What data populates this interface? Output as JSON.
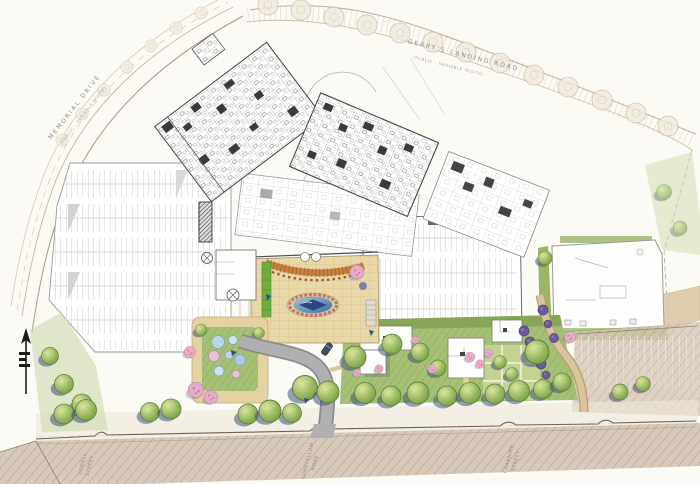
{
  "drawing": {
    "kind": "hand-rendered illustrative site plan",
    "labels": {
      "memorial": {
        "name": "MEMORIAL   DRIVE",
        "sub": "(PUBLIC - VARIABLE WIDTH)"
      },
      "gerrys": {
        "name": "GERRY'S   LANDING   ROAD",
        "sub": "(PUBLIC - VARIABLE WIDTH)"
      },
      "lowell": {
        "l1": "LOWELL",
        "l2": "STREET"
      },
      "longfellow": {
        "l1": "LONGFELLOW",
        "l2": "ROAD"
      },
      "channing": {
        "l1": "CHANNING",
        "l2": "STREET"
      }
    },
    "features": {
      "north_arrow": "north-arrow-and-scale",
      "hospital": "main-hospital-building-plan",
      "west_parking": "west-parking-lot",
      "east_parking": "east-parking-deck",
      "plaza": "entry-plaza-courtyard",
      "pond": "oval-reflecting-pool",
      "trellis": "curved-entry-trellis",
      "childrens_garden": "childrens-garden",
      "cottages": "garden-cottages",
      "street_trees": "street-tree-row",
      "south_road": "mount-auburn-street-roadbed"
    },
    "palette": {
      "paper": "#fbfaf5",
      "plaza_tan": "#e9d9a8",
      "pond_deep": "#1e3f73",
      "trellis_orange": "#c87f3e",
      "lawn_green": "#a6c076",
      "tree_green": "#8cb05b",
      "shadow_blue": "#45527c",
      "flower_pink": "#dfa5bc",
      "planting_purple": "#65558f",
      "road_hatch": "#c6b29c",
      "parking_line": "#b5b5b5",
      "ink": "#4a4a4a"
    }
  }
}
